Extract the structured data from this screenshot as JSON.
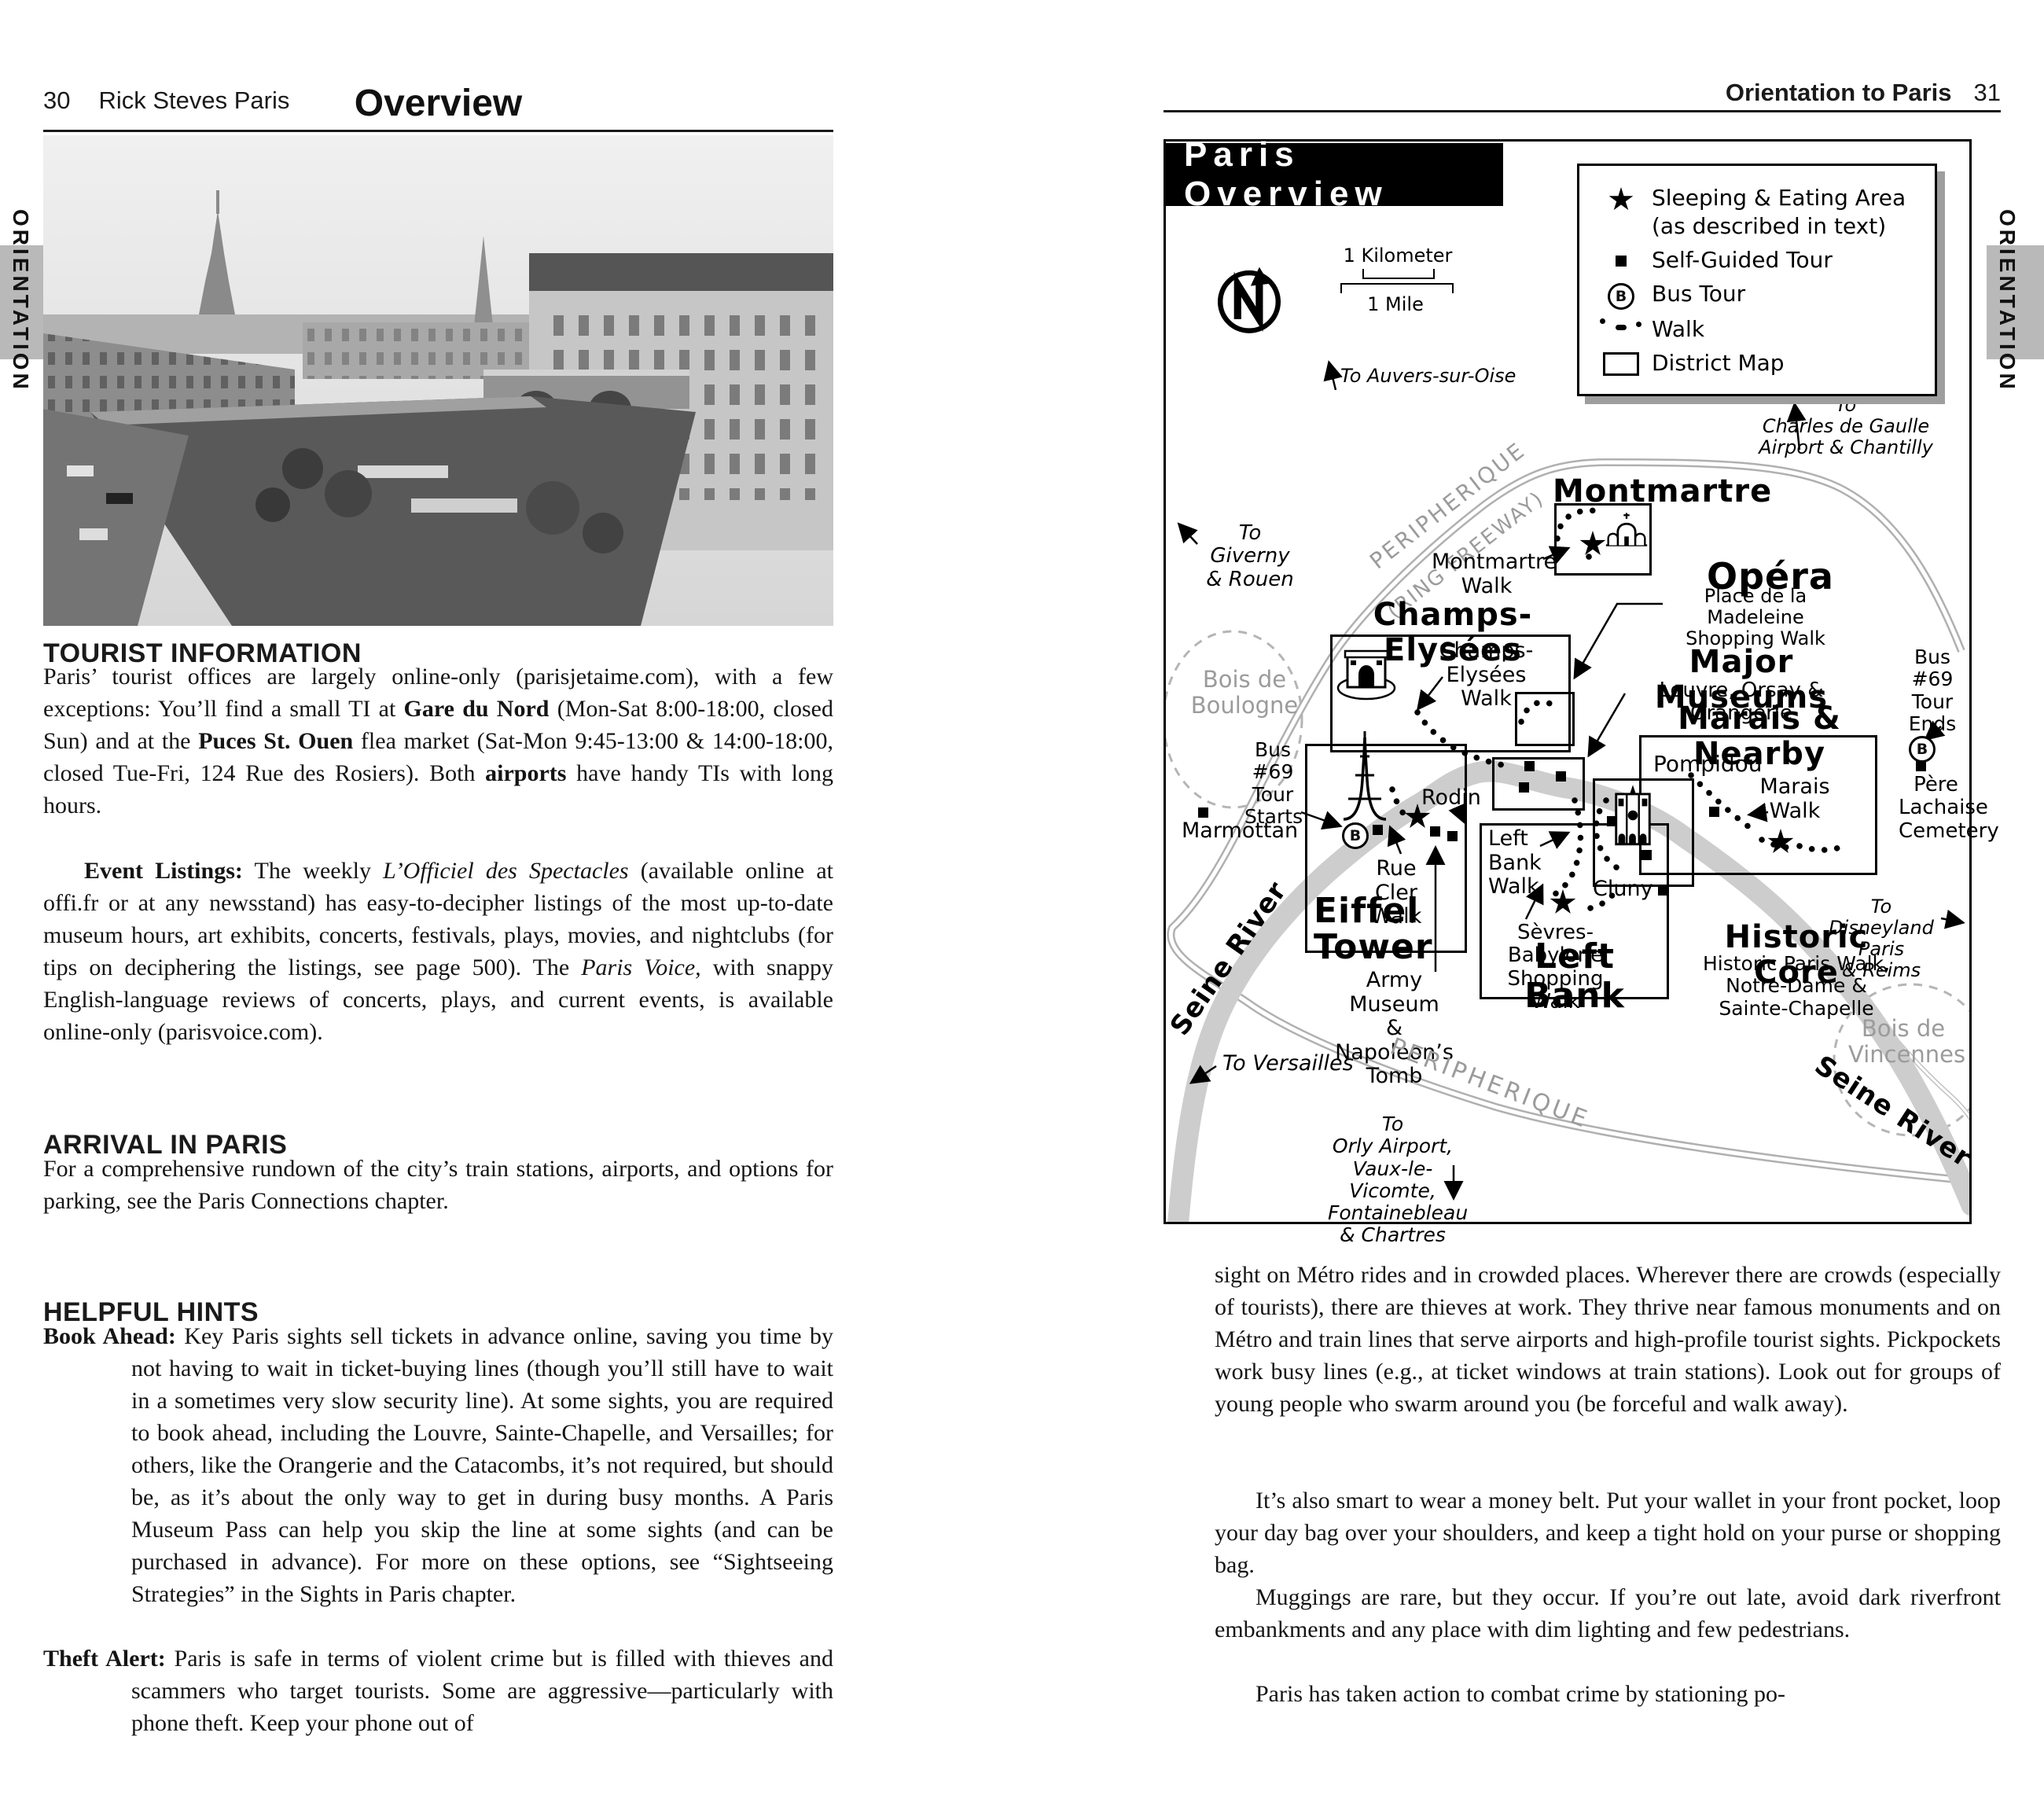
{
  "left_page": {
    "tab": "ORIENTATION",
    "page_num": "30",
    "book_title": "Rick Steves Paris",
    "title": "Overview",
    "tourist_heading": "TOURIST INFORMATION",
    "p1": [
      "Paris’ tourist offices are largely online-only (parisjetaime.com), with a few exceptions: You’ll find a small TI at ",
      "Gare du Nord",
      " (Mon-Sat 8:00-18:00, closed Sun) and at the ",
      "Puces St. Ouen",
      " flea market (Sat-Mon 9:45-13:00 & 14:00-18:00, closed Tue-Fri, 124 Rue des Rosiers). Both ",
      "airports",
      " have handy TIs with long hours."
    ],
    "p2": [
      "Event Listings:",
      " The weekly ",
      "L’Officiel des Spectacles",
      " (available online at offi.fr or at any newsstand) has easy-to-decipher listings of the most up-to-date museum hours, art exhibits, concerts, festivals, plays, movies, and nightclubs (for tips on deciphering the listings, see page 500). The ",
      "Paris Voice,",
      " with snappy English-language reviews of concerts, plays, and current events, is available online-only (parisvoice.com)."
    ],
    "arrival_heading": "ARRIVAL IN PARIS",
    "arrival_p": "For a comprehensive rundown of the city’s train stations, airports, and options for parking, see the Paris Connections chapter.",
    "hints_heading": "HELPFUL HINTS",
    "hint1_lead": "Book Ahead:",
    "hint1_text": " Key Paris sights sell tickets in advance online, saving you time by not having to wait in ticket-buying lines (though you’ll still have to wait in a sometimes very slow security line). At some sights, you are required to book ahead, including the Louvre, Sainte-Chapelle, and Versailles; for others, like the Orangerie and the Catacombs, it’s not required, but should be, as it’s about the only way to get in during busy months. A Paris Museum Pass can help you skip the line at some sights (and can be purchased in advance). For more on these options, see “Sightseeing Strategies” in the Sights in Paris chapter.",
    "hint2_lead": "Theft Alert:",
    "hint2_text": " Paris is safe in terms of violent crime but is filled with thieves and scammers who target tourists. Some are aggressive—particularly with phone theft. Keep your phone out of"
  },
  "right_page": {
    "tab": "ORIENTATION",
    "page_num": "31",
    "chapter_title": "Orientation to Paris",
    "p1": "sight on Métro rides and in crowded places. Wherever there are crowds (especially of tourists), there are thieves at work. They thrive near famous monuments and on Métro and train lines that serve airports and high-profile tourist sights. Pickpockets work busy lines (e.g., at ticket windows at train stations). Look out for groups of young people who swarm around you (be forceful and walk away).",
    "p2": "It’s also smart to wear a money belt. Put your wallet in your front pocket, loop your day bag over your shoulders, and keep a tight hold on your purse or shopping bag.",
    "p3": "Muggings are rare, but they occur. If you’re out late, avoid dark riverfront embankments and any place with dim lighting and few pedestrians.",
    "p4": "Paris has taken action to combat crime by stationing po-",
    "map": {
      "title": "Paris Overview",
      "bus_b": "B",
      "legend": {
        "sleeping1": "Sleeping & Eating Area",
        "sleeping2": "(as described in text)",
        "tour": "Self-Guided Tour",
        "bus": "Bus Tour",
        "walk": "Walk",
        "district": "District Map"
      },
      "compass_n": "N",
      "scale_km": "1 Kilometer",
      "scale_mile": "1 Mile",
      "to_auvers": "To Auvers-sur-Oise",
      "to_cdg": "To\nCharles de Gaulle\nAirport & Chantilly",
      "to_giverny": "To Giverny\n& Rouen",
      "periph1": "PERIPHERIQUE",
      "periph2": "(RING FREEWAY)",
      "periph3": "PERIPHERIQUE",
      "montmartre": "Montmartre",
      "montmartre_walk": "Montmartre\nWalk",
      "opera": "Opéra",
      "madeleine_walk": "Place de la Madeleine\nShopping Walk",
      "champs": "Champs-Elysées",
      "champs_walk": "Champs-Elysées\nWalk",
      "bois_boulogne": "Bois de\nBoulogne",
      "major_museums": "Major Museums",
      "major_museums_sub": "Louvre, Orsay & Orangerie",
      "marais": "Marais & Nearby",
      "pompidou": "Pompidou",
      "marais_walk": "Marais\nWalk",
      "bus69_ends": "Bus\n#69\nTour\nEnds",
      "pere_lachaise": "Père\nLachaise\nCemetery",
      "bus69_starts": "Bus\n#69\nTour\nStarts",
      "marmottan": "Marmottan",
      "rodin": "Rodin",
      "rue_cler_walk": "Rue Cler\nWalk",
      "eiffel_tower": "Eiffel\nTower",
      "left_bank_walk": "Left\nBank\nWalk",
      "cluny": "Cluny",
      "sevres": "Sèvres-Babylone\nShopping Walk",
      "left_bank": "Left Bank",
      "army": "Army Museum\n& Napoleon’s\nTomb",
      "historic_core": "Historic Core",
      "historic_sub": "Historic Paris Walk,\nNotre-Dame &\nSainte-Chapelle",
      "to_disneyland": "To Disneyland Paris\n& Reims",
      "bois_vincennes": "Bois de\nVincennes",
      "seine_west": "Seine River",
      "seine_east": "Seine River",
      "to_versailles": "To Versailles",
      "to_orly": "To\nOrly Airport,\nVaux-le-Vicomte,\nFontainebleau\n& Chartres"
    }
  }
}
